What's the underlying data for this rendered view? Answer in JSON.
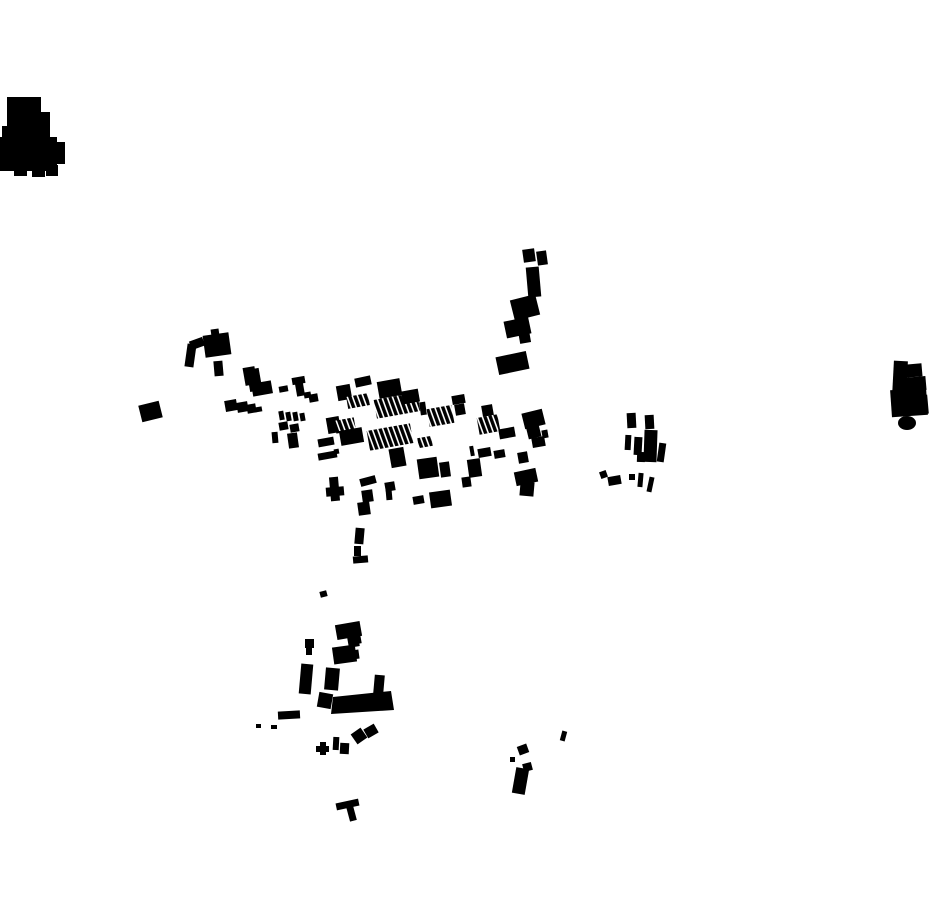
{
  "map": {
    "kind": "building-footprint-map",
    "canvas": {
      "width": 930,
      "height": 924
    },
    "colors": {
      "background": "#ffffff",
      "ink": "#000000",
      "hatch_gap": "#ffffff"
    },
    "hatch": {
      "period": 5,
      "bar": 3.4,
      "angle": -10
    },
    "clusters": [
      {
        "name": "northwest-blob",
        "shapes": [
          [
            "r",
            7,
            97,
            34,
            30,
            0
          ],
          [
            "r",
            35,
            112,
            15,
            22,
            0
          ],
          [
            "r",
            2,
            126,
            48,
            25,
            0
          ],
          [
            "r",
            0,
            137,
            57,
            34,
            0
          ],
          [
            "r",
            52,
            142,
            13,
            22,
            0
          ],
          [
            "r",
            14,
            165,
            13,
            11,
            0
          ],
          [
            "r",
            32,
            167,
            13,
            10,
            0
          ],
          [
            "r",
            46,
            165,
            12,
            11,
            0
          ]
        ]
      },
      {
        "name": "far-east-blob",
        "shapes": [
          [
            "r",
            893,
            361,
            14,
            35,
            3
          ],
          [
            "r",
            905,
            364,
            17,
            13,
            -5
          ],
          [
            "r",
            902,
            377,
            24,
            14,
            -5
          ],
          [
            "r",
            891,
            389,
            36,
            27,
            -4
          ],
          [
            "r",
            918,
            395,
            10,
            19,
            -5
          ],
          [
            "e",
            907,
            423,
            9,
            7
          ]
        ]
      },
      {
        "name": "north-arm",
        "shapes": [
          [
            "r",
            523,
            249,
            12,
            13,
            -8
          ],
          [
            "r",
            537,
            251,
            10,
            14,
            -8
          ],
          [
            "r",
            527,
            267,
            13,
            30,
            -5
          ],
          [
            "r",
            512,
            297,
            26,
            21,
            -14
          ],
          [
            "r",
            505,
            319,
            25,
            17,
            -12
          ],
          [
            "r",
            519,
            330,
            11,
            13,
            -10
          ],
          [
            "r",
            497,
            354,
            31,
            18,
            -12
          ]
        ]
      },
      {
        "name": "west-outskirts",
        "shapes": [
          [
            "r",
            186,
            344,
            9,
            23,
            8
          ],
          [
            "r",
            190,
            339,
            14,
            9,
            -20
          ],
          [
            "r",
            204,
            334,
            26,
            22,
            -8
          ],
          [
            "r",
            211,
            329,
            8,
            7,
            -8
          ],
          [
            "r",
            214,
            361,
            9,
            15,
            -5
          ],
          [
            "r",
            244,
            367,
            12,
            18,
            -10
          ],
          [
            "r",
            249,
            378,
            12,
            13,
            -10
          ],
          [
            "r",
            140,
            403,
            21,
            17,
            -14
          ]
        ]
      },
      {
        "name": "west-row",
        "shapes": [
          [
            "r",
            225,
            400,
            12,
            11,
            -10
          ],
          [
            "r",
            237,
            402,
            11,
            10,
            -10
          ],
          [
            "r",
            247,
            404,
            9,
            9,
            -10
          ],
          [
            "r",
            254,
            407,
            8,
            5,
            -10
          ],
          [
            "r",
            246,
            369,
            14,
            15,
            -10
          ],
          [
            "r",
            252,
            382,
            20,
            13,
            -10
          ],
          [
            "r",
            279,
            386,
            9,
            6,
            -10
          ],
          [
            "r",
            292,
            377,
            13,
            7,
            -10
          ],
          [
            "r",
            296,
            383,
            8,
            13,
            -10
          ],
          [
            "r",
            304,
            392,
            7,
            6,
            -10
          ],
          [
            "r",
            309,
            394,
            9,
            8,
            -10
          ],
          [
            "r",
            279,
            411,
            5,
            9,
            -10
          ],
          [
            "r",
            286,
            412,
            5,
            9,
            -10
          ],
          [
            "r",
            293,
            412,
            5,
            9,
            -10
          ],
          [
            "r",
            300,
            413,
            5,
            8,
            -10
          ],
          [
            "r",
            279,
            422,
            9,
            8,
            -10
          ],
          [
            "r",
            290,
            424,
            9,
            8,
            -10
          ],
          [
            "r",
            272,
            432,
            6,
            11,
            -5
          ],
          [
            "r",
            288,
            433,
            10,
            15,
            -8
          ],
          [
            "r",
            327,
            417,
            13,
            16,
            -10
          ],
          [
            "r",
            318,
            438,
            16,
            8,
            -10
          ],
          [
            "r",
            334,
            449,
            5,
            5,
            -10
          ],
          [
            "r",
            318,
            452,
            19,
            7,
            -10
          ]
        ]
      },
      {
        "name": "main-band",
        "shapes": [
          [
            "r",
            337,
            385,
            14,
            15,
            -10
          ],
          [
            "r",
            355,
            377,
            16,
            9,
            -12
          ],
          [
            "r",
            378,
            380,
            23,
            17,
            -10
          ],
          [
            "h",
            347,
            395,
            22,
            12,
            -10
          ],
          [
            "h",
            375,
            396,
            44,
            19,
            -10
          ],
          [
            "r",
            402,
            390,
            17,
            13,
            -10
          ],
          [
            "r",
            420,
            402,
            6,
            13,
            -8
          ],
          [
            "h",
            428,
            407,
            25,
            18,
            -10
          ],
          [
            "r",
            452,
            395,
            13,
            9,
            -10
          ],
          [
            "r",
            455,
            404,
            10,
            11,
            -10
          ],
          [
            "r",
            482,
            405,
            11,
            11,
            -10
          ],
          [
            "h",
            478,
            416,
            21,
            17,
            -10
          ],
          [
            "r",
            499,
            428,
            16,
            10,
            -10
          ],
          [
            "r",
            523,
            411,
            21,
            16,
            -14
          ],
          [
            "r",
            527,
            424,
            13,
            14,
            -14
          ],
          [
            "r",
            542,
            430,
            6,
            8,
            -10
          ],
          [
            "r",
            532,
            437,
            13,
            10,
            -10
          ],
          [
            "h",
            335,
            419,
            20,
            13,
            -10
          ],
          [
            "r",
            340,
            429,
            23,
            15,
            -10
          ],
          [
            "h",
            368,
            427,
            44,
            20,
            -10
          ],
          [
            "h",
            418,
            437,
            14,
            10,
            -10
          ],
          [
            "r",
            390,
            448,
            15,
            19,
            -10
          ],
          [
            "r",
            418,
            458,
            20,
            20,
            -8
          ],
          [
            "r",
            440,
            462,
            10,
            15,
            -8
          ],
          [
            "r",
            470,
            446,
            4,
            10,
            -10
          ],
          [
            "r",
            478,
            448,
            13,
            9,
            -10
          ],
          [
            "r",
            494,
            450,
            11,
            8,
            -10
          ],
          [
            "r",
            468,
            459,
            13,
            18,
            -8
          ],
          [
            "r",
            462,
            477,
            9,
            10,
            -8
          ],
          [
            "r",
            518,
            452,
            10,
            11,
            -10
          ],
          [
            "r",
            515,
            470,
            22,
            14,
            -12
          ],
          [
            "r",
            520,
            482,
            14,
            14,
            5
          ],
          [
            "r",
            330,
            477,
            9,
            24,
            -5
          ],
          [
            "r",
            326,
            487,
            18,
            9,
            -5
          ],
          [
            "r",
            360,
            477,
            16,
            8,
            -15
          ],
          [
            "r",
            385,
            482,
            10,
            9,
            -10
          ],
          [
            "r",
            386,
            489,
            6,
            11,
            -5
          ],
          [
            "r",
            362,
            490,
            11,
            12,
            -8
          ],
          [
            "r",
            358,
            502,
            12,
            13,
            -8
          ],
          [
            "r",
            413,
            496,
            11,
            8,
            -10
          ],
          [
            "r",
            430,
            491,
            21,
            16,
            -8
          ],
          [
            "r",
            355,
            528,
            9,
            16,
            5
          ],
          [
            "r",
            354,
            546,
            7,
            10,
            0
          ],
          [
            "r",
            353,
            556,
            15,
            7,
            -5
          ],
          [
            "r",
            320,
            591,
            7,
            6,
            -15
          ]
        ]
      },
      {
        "name": "east-group",
        "shapes": [
          [
            "r",
            627,
            413,
            9,
            15,
            -3
          ],
          [
            "r",
            645,
            415,
            9,
            14,
            -3
          ],
          [
            "r",
            625,
            435,
            6,
            15,
            3
          ],
          [
            "r",
            634,
            437,
            8,
            18,
            3
          ],
          [
            "r",
            644,
            430,
            13,
            32,
            2
          ],
          [
            "r",
            637,
            452,
            8,
            10,
            2
          ],
          [
            "r",
            658,
            443,
            7,
            19,
            8
          ],
          [
            "r",
            600,
            471,
            7,
            7,
            -20
          ],
          [
            "r",
            608,
            476,
            13,
            9,
            -10
          ],
          [
            "r",
            629,
            474,
            6,
            6,
            0
          ],
          [
            "r",
            638,
            473,
            5,
            14,
            5
          ],
          [
            "r",
            648,
            477,
            5,
            15,
            12
          ]
        ]
      },
      {
        "name": "south-village",
        "shapes": [
          [
            "r",
            336,
            623,
            25,
            15,
            -10
          ],
          [
            "r",
            352,
            635,
            9,
            9,
            -10
          ],
          [
            "r",
            348,
            637,
            11,
            10,
            -10
          ],
          [
            "r",
            333,
            646,
            23,
            17,
            -8
          ],
          [
            "r",
            352,
            650,
            7,
            9,
            -8
          ],
          [
            "r",
            305,
            639,
            9,
            9,
            0
          ],
          [
            "r",
            306,
            646,
            6,
            9,
            0
          ],
          [
            "r",
            300,
            664,
            12,
            30,
            5
          ],
          [
            "r",
            325,
            668,
            14,
            22,
            5
          ],
          [
            "r",
            318,
            693,
            14,
            15,
            10
          ],
          [
            "r",
            374,
            675,
            10,
            19,
            5
          ],
          [
            "p",
            "333,697 391,691 394,710 331,714"
          ],
          [
            "r",
            278,
            711,
            22,
            8,
            -3
          ],
          [
            "r",
            256,
            724,
            5,
            4,
            0
          ],
          [
            "r",
            271,
            725,
            6,
            4,
            0
          ],
          [
            "r",
            320,
            742,
            6,
            13,
            0
          ],
          [
            "r",
            316,
            746,
            13,
            6,
            0
          ],
          [
            "r",
            333,
            737,
            6,
            13,
            3
          ],
          [
            "r",
            340,
            743,
            9,
            11,
            3
          ],
          [
            "r",
            353,
            730,
            12,
            12,
            -35
          ],
          [
            "r",
            365,
            726,
            12,
            10,
            -30
          ]
        ]
      },
      {
        "name": "southeast-marks",
        "shapes": [
          [
            "r",
            561,
            731,
            5,
            10,
            15
          ],
          [
            "r",
            518,
            745,
            10,
            9,
            -20
          ],
          [
            "r",
            510,
            757,
            5,
            5,
            0
          ],
          [
            "r",
            523,
            763,
            9,
            8,
            -15
          ],
          [
            "r",
            514,
            768,
            13,
            26,
            10
          ]
        ]
      },
      {
        "name": "south-lone",
        "shapes": [
          [
            "r",
            336,
            801,
            23,
            7,
            -12
          ],
          [
            "r",
            348,
            806,
            7,
            15,
            -15
          ]
        ]
      }
    ]
  }
}
